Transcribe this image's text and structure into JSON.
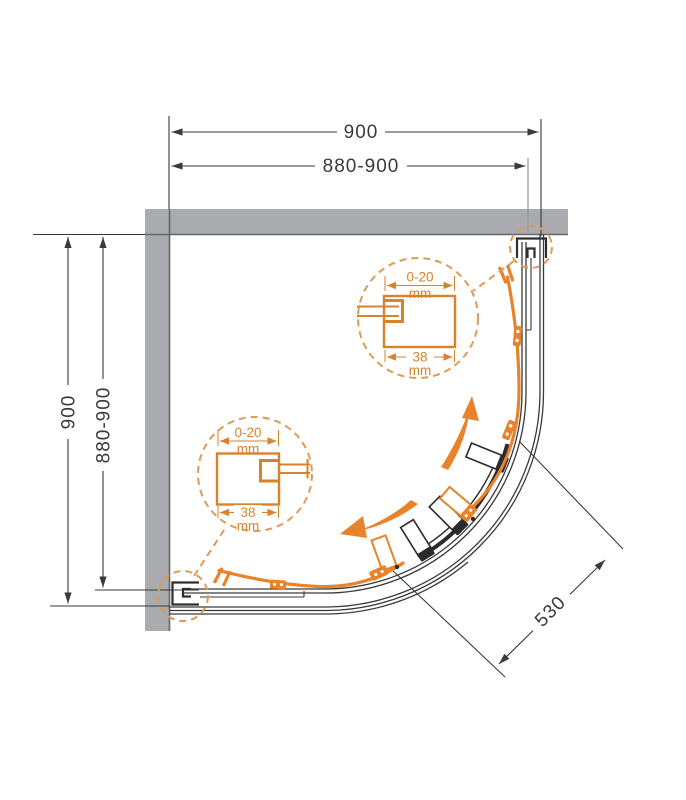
{
  "drawing": {
    "dimensions": {
      "top_overall": "900",
      "top_adjustable": "880-900",
      "left_overall": "900",
      "left_adjustable": "880-900",
      "radius": "530"
    },
    "details": {
      "top": {
        "adjust_range": "0-20",
        "adjust_unit": "mm",
        "profile_width": "38",
        "width_unit": "mm"
      },
      "bottom": {
        "adjust_range": "0-20",
        "adjust_unit": "mm",
        "profile_width": "38",
        "width_unit": "mm"
      }
    },
    "colors": {
      "accent_orange": "#e8832b",
      "detail_orange": "#d9822e",
      "dashed_orange": "#e09a54",
      "wall_gray": "#a9abaf",
      "line_dark": "#3a3a3a"
    }
  }
}
